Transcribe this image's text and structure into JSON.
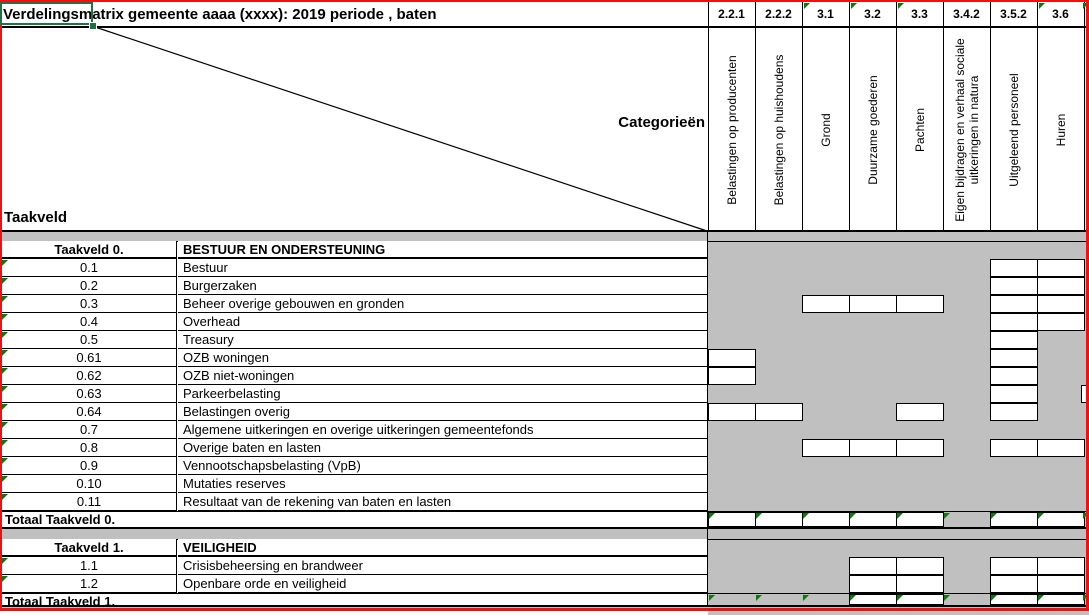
{
  "title": "Verdelingsmatrix gemeente aaaa (xxxx): 2019  periode , baten",
  "corner": {
    "categorien_label": "Categorieën",
    "taakveld_label": "Taakveld"
  },
  "columns": [
    {
      "code": "2.2.1",
      "label": "Belastingen op producenten",
      "flag": false
    },
    {
      "code": "2.2.2",
      "label": "Belastingen op huishoudens",
      "flag": false
    },
    {
      "code": "3.1",
      "label": "Grond",
      "flag": true
    },
    {
      "code": "3.2",
      "label": "Duurzame goederen",
      "flag": true
    },
    {
      "code": "3.3",
      "label": "Pachten",
      "flag": true
    },
    {
      "code": "3.4.2",
      "label": "Eigen bijdragen en verhaal sociale uitkeringen in natura",
      "flag": false
    },
    {
      "code": "3.5.2",
      "label": "Uitgeleend personeel",
      "flag": false
    },
    {
      "code": "3.6",
      "label": "Huren",
      "flag": true
    }
  ],
  "edge_column_flag": true,
  "sections": [
    {
      "code": "Taakveld 0.",
      "name": "BESTUUR EN ONDERSTEUNING",
      "rows": [
        {
          "code": "0.1",
          "name": "Bestuur",
          "open": [
            7,
            8
          ],
          "edge_open": false
        },
        {
          "code": "0.2",
          "name": "Burgerzaken",
          "open": [
            7,
            8
          ],
          "edge_open": false
        },
        {
          "code": "0.3",
          "name": "Beheer overige gebouwen en gronden",
          "open": [
            3,
            4,
            5,
            7,
            8
          ],
          "edge_open": false
        },
        {
          "code": "0.4",
          "name": "Overhead",
          "open": [
            7,
            8
          ],
          "edge_open": false
        },
        {
          "code": "0.5",
          "name": "Treasury",
          "open": [
            7
          ],
          "edge_open": false
        },
        {
          "code": "0.61",
          "name": "OZB woningen",
          "open": [
            1,
            7
          ],
          "edge_open": false
        },
        {
          "code": "0.62",
          "name": "OZB niet-woningen",
          "open": [
            1,
            7
          ],
          "edge_open": false
        },
        {
          "code": "0.63",
          "name": "Parkeerbelasting",
          "open": [
            7
          ],
          "edge_open": true
        },
        {
          "code": "0.64",
          "name": "Belastingen overig",
          "open": [
            1,
            2,
            5,
            7
          ],
          "edge_open": false
        },
        {
          "code": "0.7",
          "name": "Algemene uitkeringen en overige uitkeringen gemeentefonds",
          "open": [],
          "edge_open": false
        },
        {
          "code": "0.8",
          "name": "Overige baten en lasten",
          "open": [
            3,
            4,
            5,
            7,
            8
          ],
          "edge_open": false
        },
        {
          "code": "0.9",
          "name": "Vennootschapsbelasting (VpB)",
          "open": [],
          "edge_open": false
        },
        {
          "code": "0.10",
          "name": "Mutaties reserves",
          "open": [],
          "edge_open": false
        },
        {
          "code": "0.11",
          "name": "Resultaat van de rekening van baten en lasten",
          "open": [],
          "edge_open": false
        }
      ],
      "total": {
        "label": "Totaal Taakveld 0.",
        "open": [
          1,
          2,
          3,
          4,
          5,
          7,
          8
        ],
        "flags": [
          1,
          2,
          3,
          4,
          5,
          6,
          7,
          8
        ],
        "edge_flag": true
      }
    },
    {
      "code": "Taakveld 1.",
      "name": "VEILIGHEID",
      "rows": [
        {
          "code": "1.1",
          "name": "Crisisbeheersing en brandweer",
          "open": [
            4,
            5,
            7,
            8
          ],
          "edge_open": false
        },
        {
          "code": "1.2",
          "name": "Openbare orde en veiligheid",
          "open": [
            4,
            5,
            7,
            8
          ],
          "edge_open": false
        }
      ],
      "total": {
        "label": "Totaal Taakveld 1.",
        "open": [
          4,
          5,
          7,
          8
        ],
        "flags": [
          1,
          2,
          3,
          4,
          5,
          6,
          7,
          8
        ],
        "edge_flag": true
      }
    }
  ],
  "colors": {
    "matrix_fill": "#c0c0c0",
    "page_border": "#ee1111",
    "marker": "#0a7a0a",
    "selection": "#1f7245",
    "grid": "#000000"
  }
}
